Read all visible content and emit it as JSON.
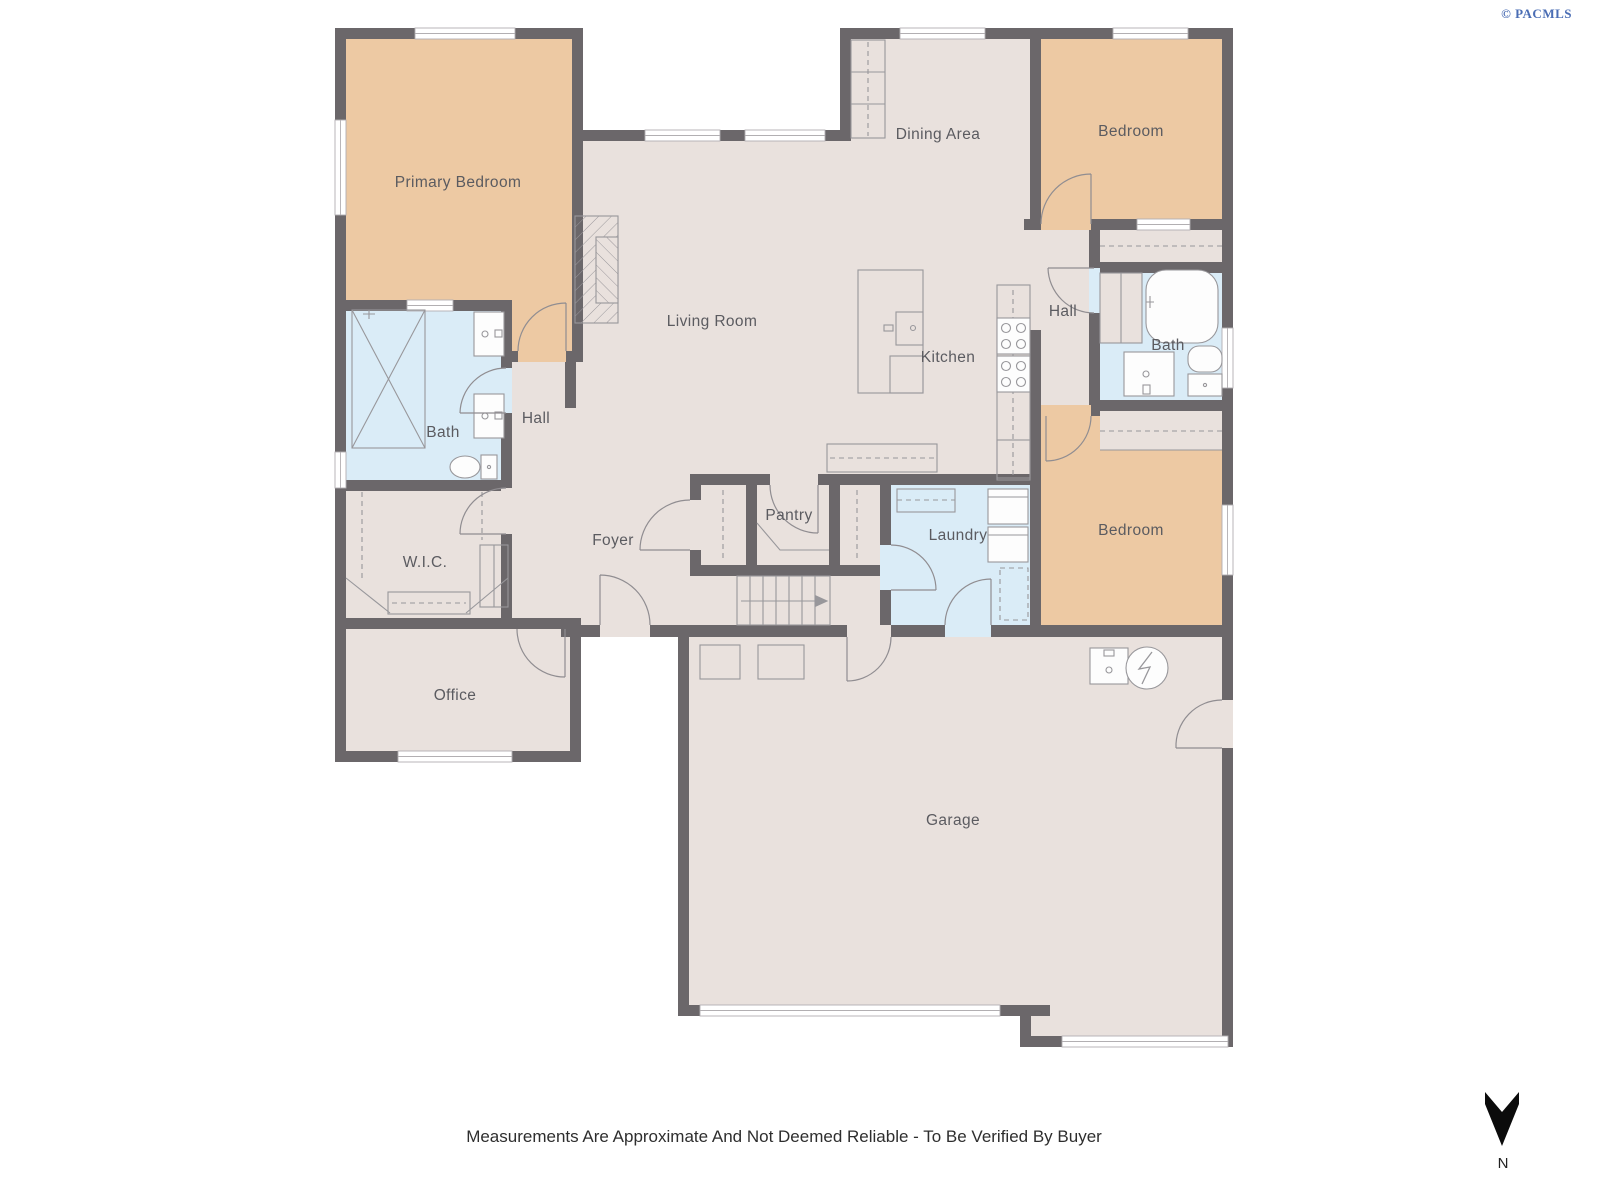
{
  "watermark": "© PACMLS",
  "disclaimer": "Measurements Are Approximate And Not Deemed Reliable - To Be Verified By Buyer",
  "compass": {
    "label": "N"
  },
  "rooms": {
    "primary_bedroom": "Primary Bedroom",
    "bedroom_top": "Bedroom",
    "bedroom_right": "Bedroom",
    "dining": "Dining Area",
    "living": "Living Room",
    "kitchen": "Kitchen",
    "hall_right": "Hall",
    "hall_left": "Hall",
    "bath_left": "Bath",
    "bath_right": "Bath",
    "wic": "W.I.C.",
    "foyer": "Foyer",
    "pantry": "Pantry",
    "laundry": "Laundry",
    "office": "Office",
    "garage": "Garage"
  },
  "colors": {
    "wall": "#6b676a",
    "floor": "#e9e1dd",
    "bedroom": "#edc9a3",
    "wet": "#daecf7",
    "fixture": "#98979b",
    "label": "#5b5b60",
    "watermark": "#4a6db4",
    "disclaimer": "#2e2e2e"
  }
}
